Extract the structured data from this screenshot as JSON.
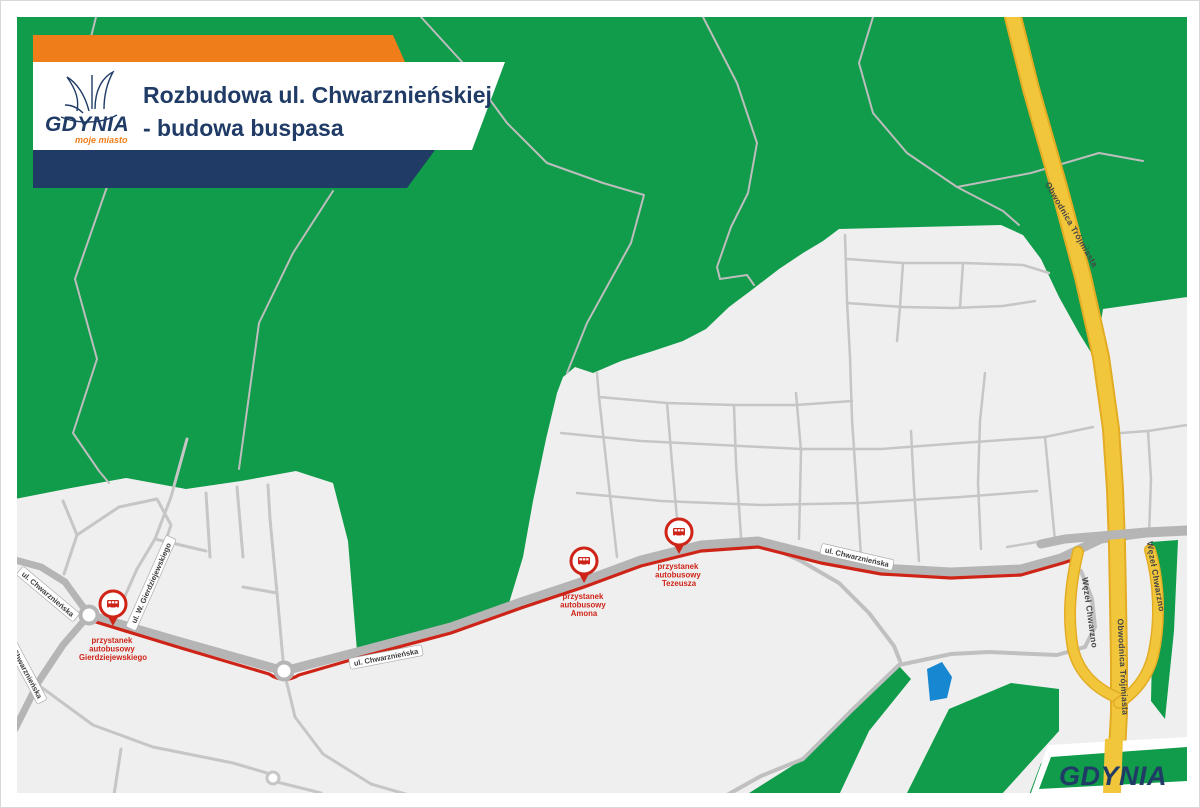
{
  "header": {
    "logo": {
      "name": "GDYNIA",
      "tagline": "moje miasto"
    },
    "title_line1": "Rozbudowa ul. Chwarznieńskiej",
    "title_line2": "- budowa buspasa"
  },
  "map": {
    "street_labels": [
      {
        "text": "ul. Chwarznieńska"
      },
      {
        "text": "ul. Chwarznieńska"
      },
      {
        "text": "ul. W. Gierdziejewskiego"
      },
      {
        "text": "ul. Chwarznieńska"
      },
      {
        "text": "ul. Chwarznieńska"
      }
    ],
    "highway_labels": [
      {
        "text": "Obwodnica Trójmiasta"
      },
      {
        "text": "Obwodnica Trójmiasta"
      },
      {
        "text": "Węzeł Chwarzno"
      },
      {
        "text": "Węzeł Chwarzno"
      }
    ],
    "bus_stops": [
      {
        "lines": [
          "przystanek",
          "autobusowy",
          "Gierdziejewskiego"
        ]
      },
      {
        "lines": [
          "przystanek",
          "autobusowy",
          "Amona"
        ]
      },
      {
        "lines": [
          "przystanek",
          "autobusowy",
          "Tezeusza"
        ]
      }
    ],
    "colors": {
      "forest_green": "#109C4A",
      "urban_gray": "#EFEFEF",
      "street_gray": "#C6C6C6",
      "main_road_gray": "#B5B5B5",
      "bus_lane_red": "#CE2418",
      "highway_yellow": "#F2C63B",
      "highway_casing": "#E2AC24",
      "navy": "#1F3B66",
      "orange": "#EF7D1A",
      "pond_blue": "#1787D2"
    }
  },
  "footer": {
    "logo_text": "GDYNIA"
  }
}
